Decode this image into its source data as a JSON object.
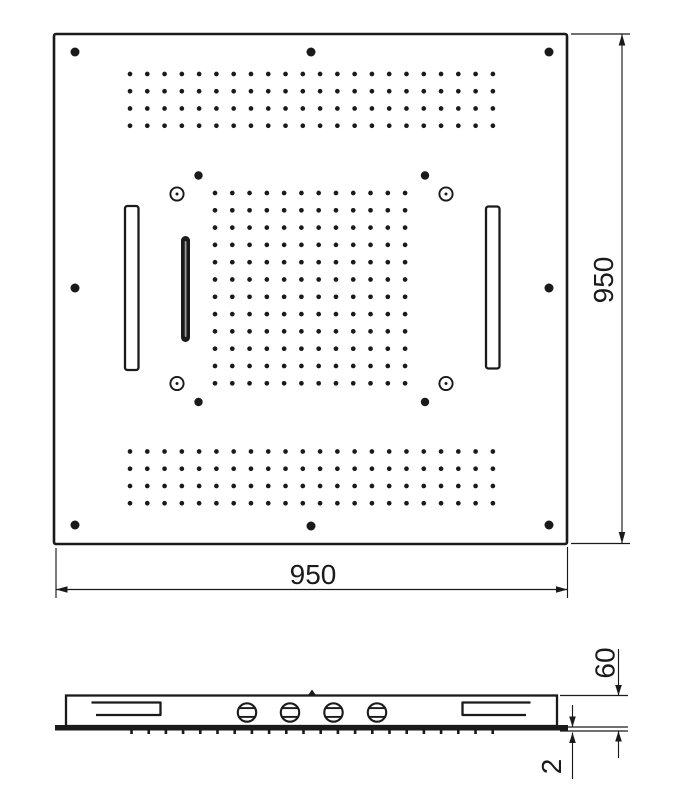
{
  "drawing": {
    "kind": "shower-head-technical-drawing",
    "colors": {
      "line": "#1a1a1a",
      "background": "#ffffff",
      "slot_streak": "#999999"
    },
    "dimensions": {
      "plan_width": {
        "value": "950"
      },
      "plan_height": {
        "value": "950"
      },
      "profile_height": {
        "value": "60"
      },
      "plate_thickness": {
        "value": "2"
      }
    },
    "patterns": {
      "top_band": {
        "cols": 22,
        "rows": 4,
        "x0": 130,
        "y0": 74,
        "dx": 17.28,
        "dy": 17.25,
        "r": 2.35
      },
      "bottom_band": {
        "cols": 22,
        "rows": 4,
        "x0": 130,
        "y0": 451.5,
        "dx": 17.28,
        "dy": 17.25,
        "r": 2.35
      },
      "center_grid": {
        "cols": 12,
        "rows": 12,
        "x0": 215,
        "y0": 193,
        "dx": 17.28,
        "dy": 17.3,
        "r": 2.35
      },
      "mount_holes": {
        "r": 4.5,
        "points": [
          [
            75,
            52
          ],
          [
            311,
            52
          ],
          [
            549,
            52
          ],
          [
            75,
            288
          ],
          [
            549,
            288
          ],
          [
            75,
            525
          ],
          [
            311,
            526
          ],
          [
            549,
            525
          ]
        ]
      },
      "pivot_holes": {
        "r": 4.2,
        "points": [
          [
            198.5,
            175.5
          ],
          [
            425,
            175.5
          ],
          [
            198.5,
            402
          ],
          [
            425,
            402
          ]
        ]
      },
      "ring_holes": {
        "r_outer": 6.6,
        "ring_stroke": 1.9,
        "r_inner": 1.5,
        "points": [
          [
            177,
            194
          ],
          [
            446,
            194
          ],
          [
            177,
            383.5
          ],
          [
            446,
            383.5
          ]
        ]
      },
      "side_ticks": {
        "count": 22,
        "x0": 131.5,
        "dx": 17.2,
        "y": 729.5,
        "w": 2.6,
        "h": 4.5
      },
      "side_valves": {
        "cy": 712.5,
        "r": 9.2,
        "chord_half": 8,
        "chord_dy": 4.4,
        "cx": [
          247,
          290,
          333.5,
          377
        ]
      }
    }
  }
}
